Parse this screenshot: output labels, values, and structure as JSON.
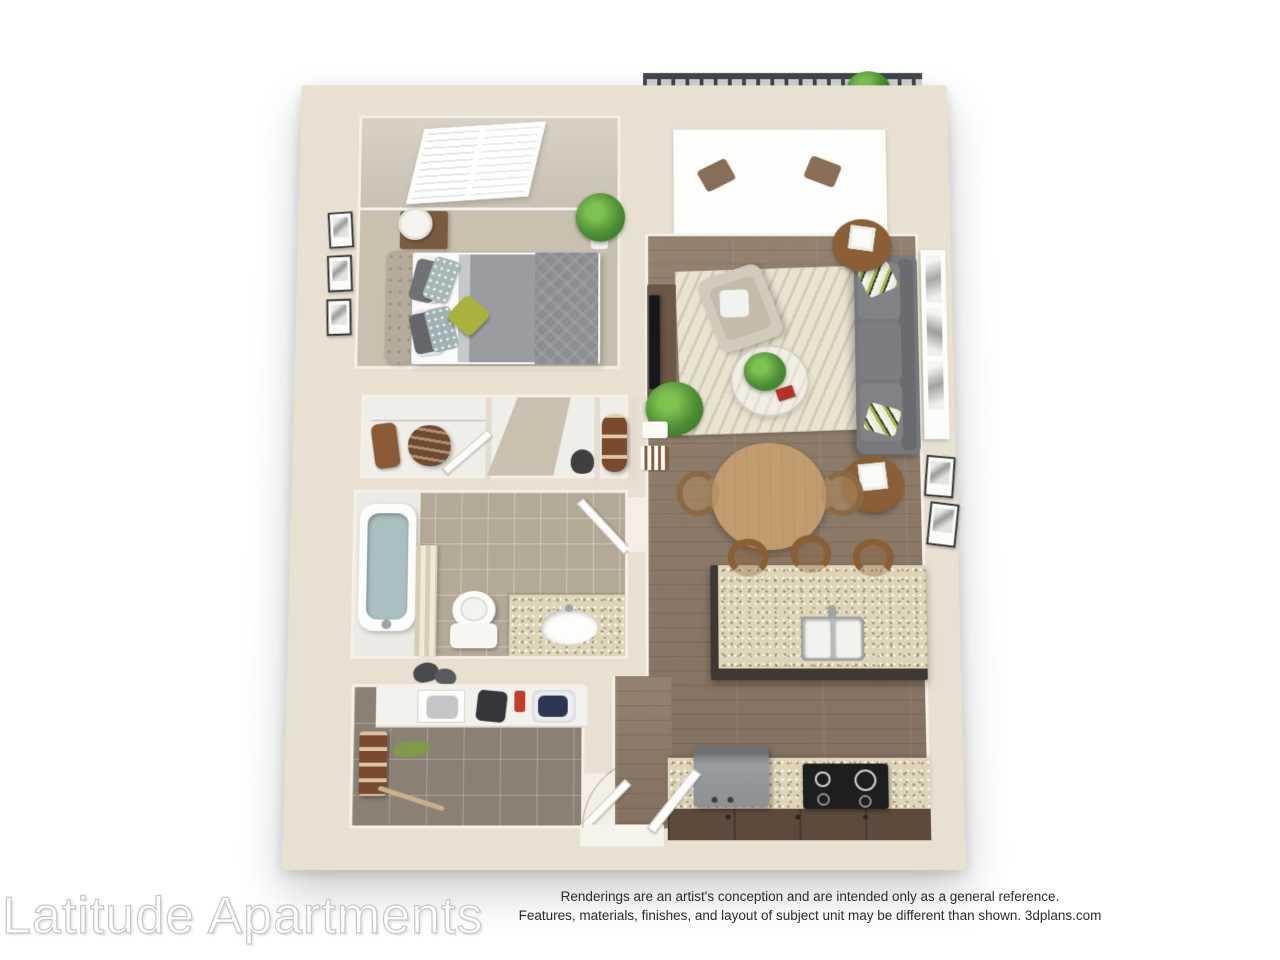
{
  "footer": {
    "watermark": "Latitude Apartments",
    "disclaimer_line1": "Renderings are an artist's conception and are intended only as a general reference.",
    "disclaimer_line2": "Features, materials, finishes, and layout of subject unit may be different than shown. 3dplans.com"
  },
  "palette": {
    "wall": "#e8e0d1",
    "wall-face": "#f5f0e6",
    "carpet": "#cac0af",
    "wood": "#8d7a68",
    "tile-bath": "#b4a896",
    "tile-utility": "#8a8174",
    "granite": "#ded4b8",
    "rug": "#e9e3d2",
    "sofa": "#77797c",
    "duvet": "#9b9ca1",
    "accent-green": "#a8b23d",
    "plant-green": "#4d8f35",
    "table-wood": "#c29c6e",
    "island-base": "#3e3a33",
    "cabinet-brown": "#5c4b3c",
    "deck": "#d6d7d3",
    "railing": "#41464c",
    "tub-water": "#a9bfc0"
  }
}
